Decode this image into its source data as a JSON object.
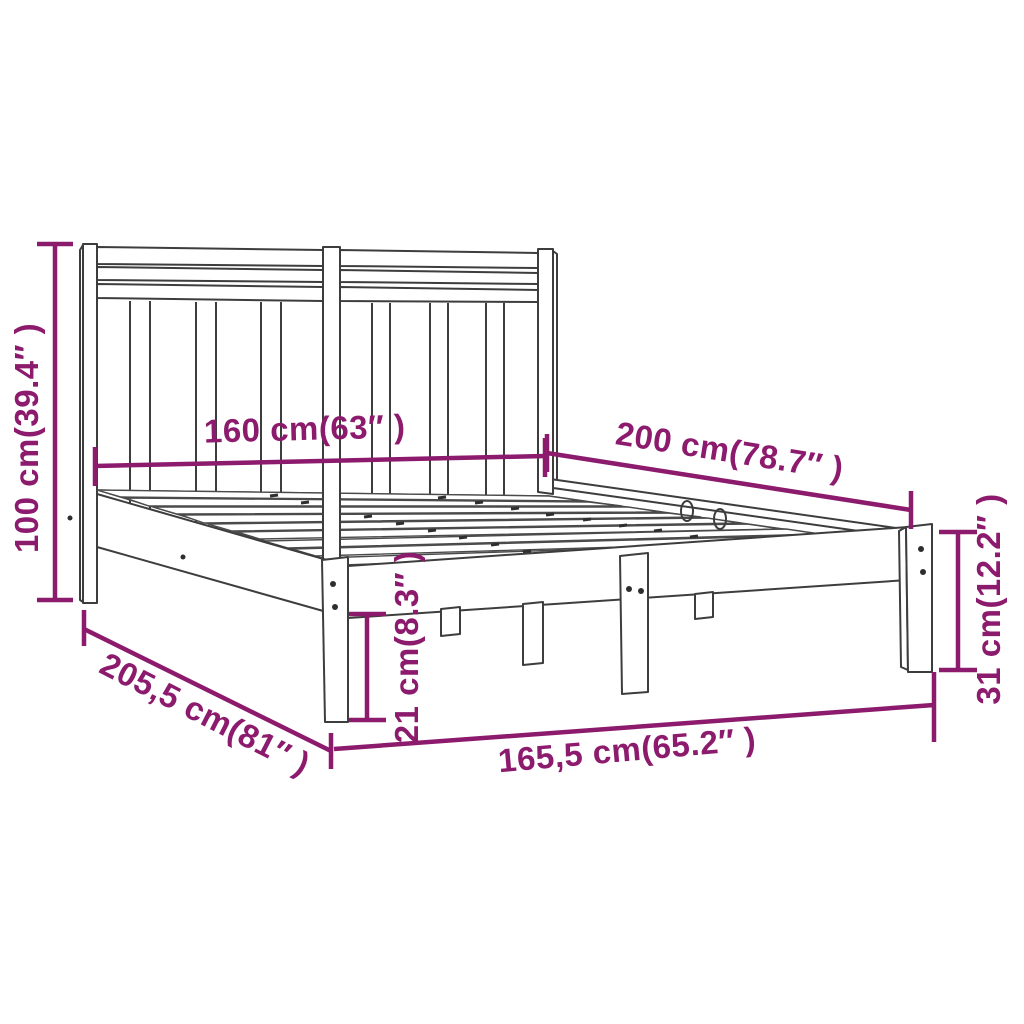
{
  "diagram": {
    "title": "bed frame dimension diagram",
    "accent_color": "#8c1a6d",
    "line_color": "#3d3d3d",
    "dimensions": {
      "headboard_height": "100 cm(39.4″ )",
      "bed_width": "160 cm(63″ )",
      "bed_length": "200 cm(78.7″ )",
      "side_rail_height": "31 cm(12.2″ )",
      "underbed_clearance": "21 cm(8.3″ )",
      "total_length": "205,5 cm(81″ )",
      "total_width": "165,5 cm(65.2″ )"
    }
  }
}
